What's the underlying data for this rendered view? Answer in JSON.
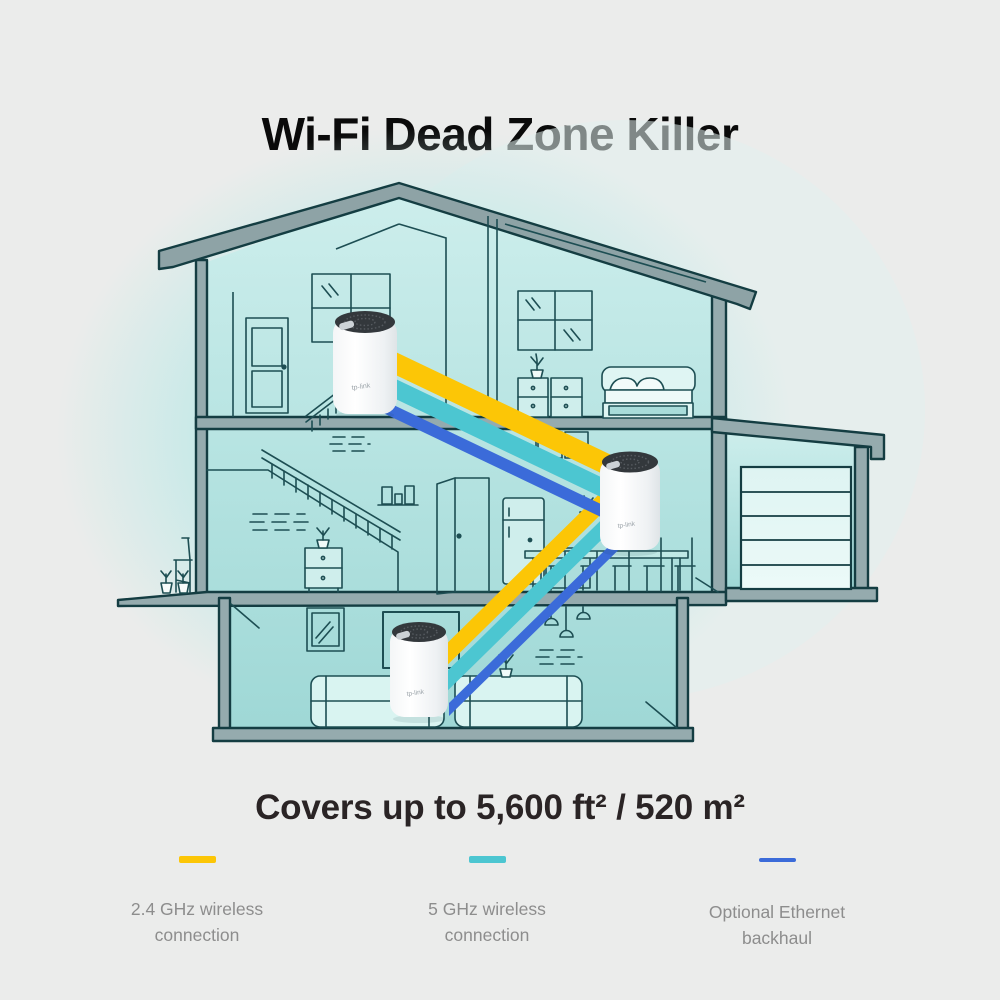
{
  "title": "Wi-Fi Dead Zone Killer",
  "coverage_caption": "Covers up to 5,600 ft² / 520 m²",
  "legend": {
    "items": [
      {
        "id": "wireless-2-4ghz",
        "label": "2.4 GHz wireless connection",
        "color": "#FCC606"
      },
      {
        "id": "wireless-5ghz",
        "label": "5 GHz wireless connection",
        "color": "#4CC6D1"
      },
      {
        "id": "ethernet-backhaul",
        "label": "Optional Ethernet backhaul",
        "color": "#3B6BD9"
      }
    ]
  },
  "scene": {
    "description": "cutaway three-level house with garage, three mesh wi-fi units linked by colored bands",
    "device_logo": "tp-link",
    "device_count": 3,
    "band_colors": {
      "wireless_24": "#FCC606",
      "wireless_5": "#4CC6D1",
      "ethernet": "#3B6BD9"
    },
    "house_colors": {
      "outline": "#143d42",
      "beam_fill": "#95abae",
      "roof_fill": "#8ea3a6",
      "room_top": "#cdeeec",
      "room_bottom": "#9fd8d6",
      "backdrop_blob": "#c7eae8"
    }
  }
}
